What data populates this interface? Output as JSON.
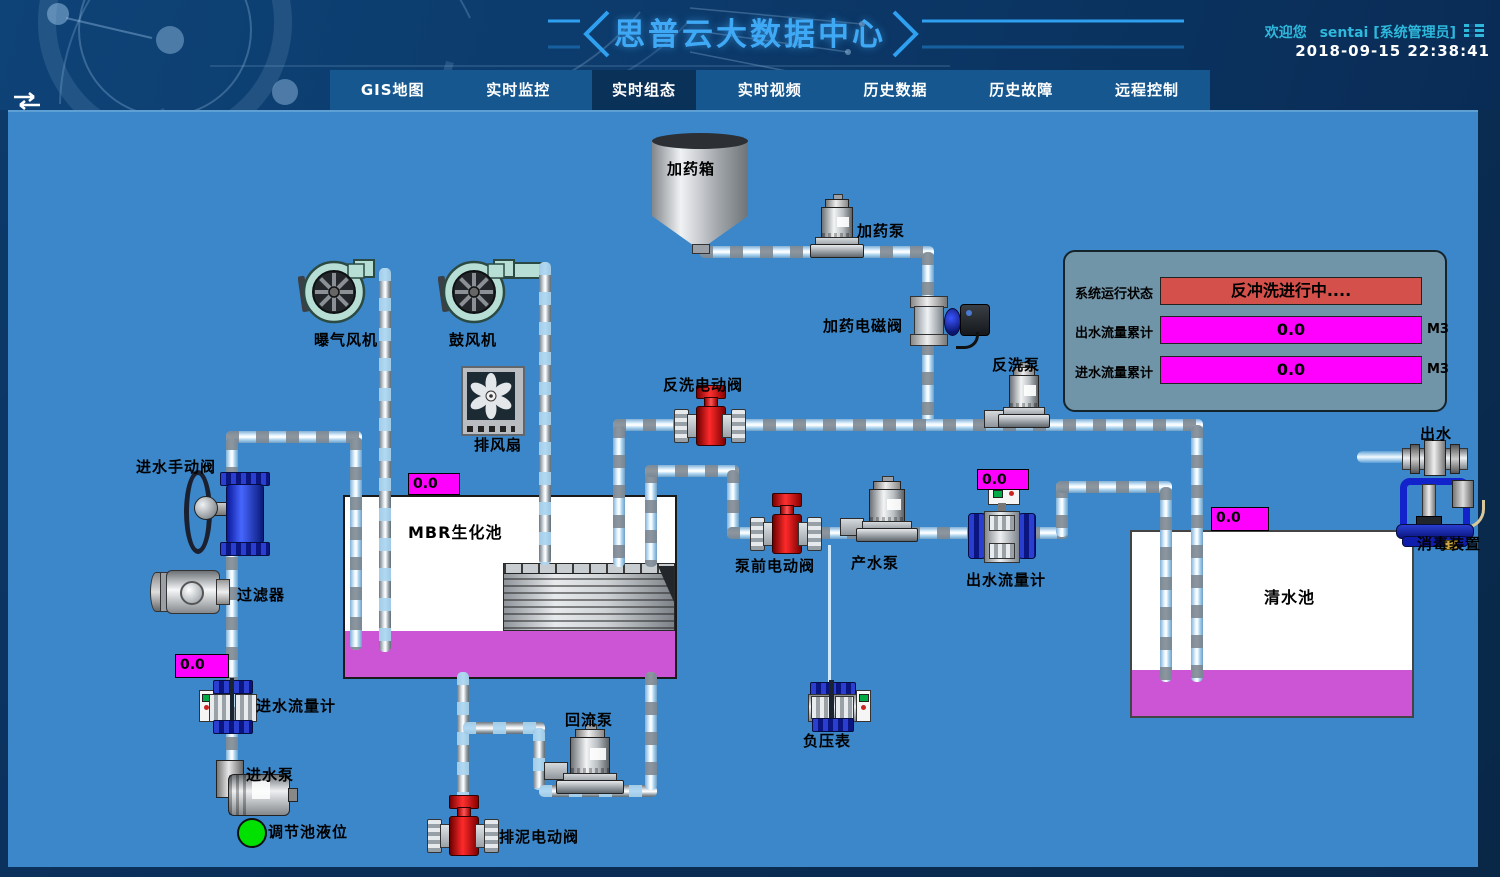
{
  "header": {
    "title": "思普云大数据中心",
    "welcome_prefix": "欢迎您",
    "username": "sentai [系统管理员]",
    "datetime": "2018-09-15 22:38:41"
  },
  "nav": {
    "active_index": 2,
    "tabs": [
      {
        "label": "GIS地图"
      },
      {
        "label": "实时监控"
      },
      {
        "label": "实时组态"
      },
      {
        "label": "实时视频"
      },
      {
        "label": "历史数据"
      },
      {
        "label": "历史故障"
      },
      {
        "label": "远程控制"
      }
    ]
  },
  "status_panel": {
    "system_status_label": "系统运行状态",
    "system_status_value": "反冲洗进行中....",
    "outlet_total_label": "出水流量累计",
    "outlet_total_value": "0.0",
    "outlet_total_unit": "M3",
    "inlet_total_label": "进水流量累计",
    "inlet_total_value": "0.0",
    "inlet_total_unit": "M3"
  },
  "equipment": {
    "dosing_tank": "加药箱",
    "dosing_pump": "加药泵",
    "dosing_solenoid_valve": "加药电磁阀",
    "aeration_blower": "曝气风机",
    "blower": "鼓风机",
    "exhaust_fan": "排风扇",
    "backwash_valve": "反洗电动阀",
    "backwash_pump": "反洗泵",
    "inlet_manual_valve": "进水手动阀",
    "filter": "过滤器",
    "inlet_flow_meter": "进水流量计",
    "inlet_pump": "进水泵",
    "regulating_tank_level": "调节池液位",
    "mbr_tank": "MBR生化池",
    "prepump_valve": "泵前电动阀",
    "product_pump": "产水泵",
    "outlet_flow_meter": "出水流量计",
    "clean_water_tank": "清水池",
    "outlet": "出水",
    "disinfection_device": "消毒装置",
    "return_pump": "回流泵",
    "sludge_valve": "排泥电动阀",
    "vacuum_gauge": "负压表"
  },
  "gauges": {
    "mbr_tank_value": "0.0",
    "inlet_flow_value": "0.0",
    "outlet_flow_value": "0.0",
    "clean_tank_value": "0.0"
  },
  "colors": {
    "canvas_blue": "#3c87c9",
    "magenta": "#ff00ff",
    "tank_liquid": "#cc55d5",
    "alarm_red": "#d4504a",
    "panel_bg": "#7094a8",
    "accent_blue": "#3fa9f5",
    "status_green": "#00e100",
    "nav_bg": "#15578e",
    "nav_active": "#0a3158"
  },
  "icons": {
    "menu": "list-icon",
    "collapse": "swap-arrows-icon"
  }
}
